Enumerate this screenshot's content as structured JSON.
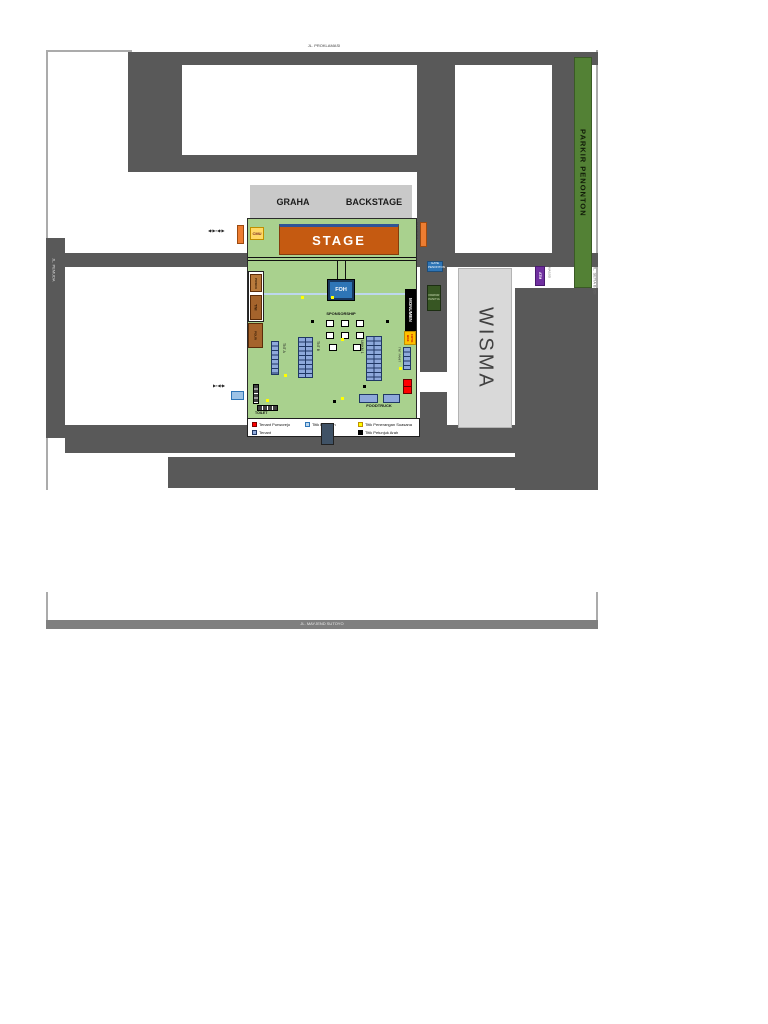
{
  "map": {
    "roads": {
      "top_label": "JL. PROKLAMASI",
      "left_label": "JL. PEMUDA",
      "right_label": "JL. SETIA BUDI",
      "bottom_label": "JL. MAYJEND SUTOYO"
    },
    "parking_strip_label": "PARKIR PENONTON",
    "buildings": {
      "graha": "GRAHA",
      "backstage": "BACKSTAGE",
      "stage": "STAGE",
      "wisma": "WISMA"
    },
    "venue": {
      "foh": "FOH",
      "sponsorship": "SPONSORSHIP",
      "monumen": "MONUMEN",
      "foto_box": "FOTO BOX",
      "foodtruck": "FOODTRUCK",
      "toilet": "TOILET",
      "cmu_badge": "CMU",
      "tenant_rows": {
        "a": "TNT A",
        "b": "TNT B",
        "umkm": "UMKM 1",
        "panitia": "TNT PANIT"
      },
      "posts": {
        "p1": "POSKO",
        "p2": "TNI",
        "p3": "POLRI"
      },
      "gates": {
        "left_arrows": "◀▪▶▪◀▪▶",
        "low_arrows": "▶▪◀▪▶",
        "stage_right_label": "PANGGUNG"
      },
      "boxes": {
        "gate_blue_line1": "GATE",
        "gate_blue_line2": "PENONTON",
        "parkir_line1": "PARKIR",
        "parkir_line2": "PANITIA",
        "atm": "ATM",
        "masjid": "MASJID",
        "pos_line1": "POS",
        "pos_line2": "INFO"
      }
    },
    "legend": {
      "items": [
        {
          "label": "Tenant Purworejo",
          "color": "#ff0000"
        },
        {
          "label": "Tenant",
          "color": "#8ea9db"
        },
        {
          "label": "Titik Lampion",
          "color": "#bdd7ee"
        },
        {
          "label": "Titik Penerangan Suasana",
          "color": "#ffff00"
        },
        {
          "label": "Titik Petunjuk Arah",
          "color": "#000000"
        }
      ]
    },
    "colors": {
      "field_green": "#a9d18e",
      "stage_orange": "#c55a11",
      "road_gray": "#595959",
      "parking_green": "#538135",
      "tenant_blue": "#8ea9db"
    }
  }
}
